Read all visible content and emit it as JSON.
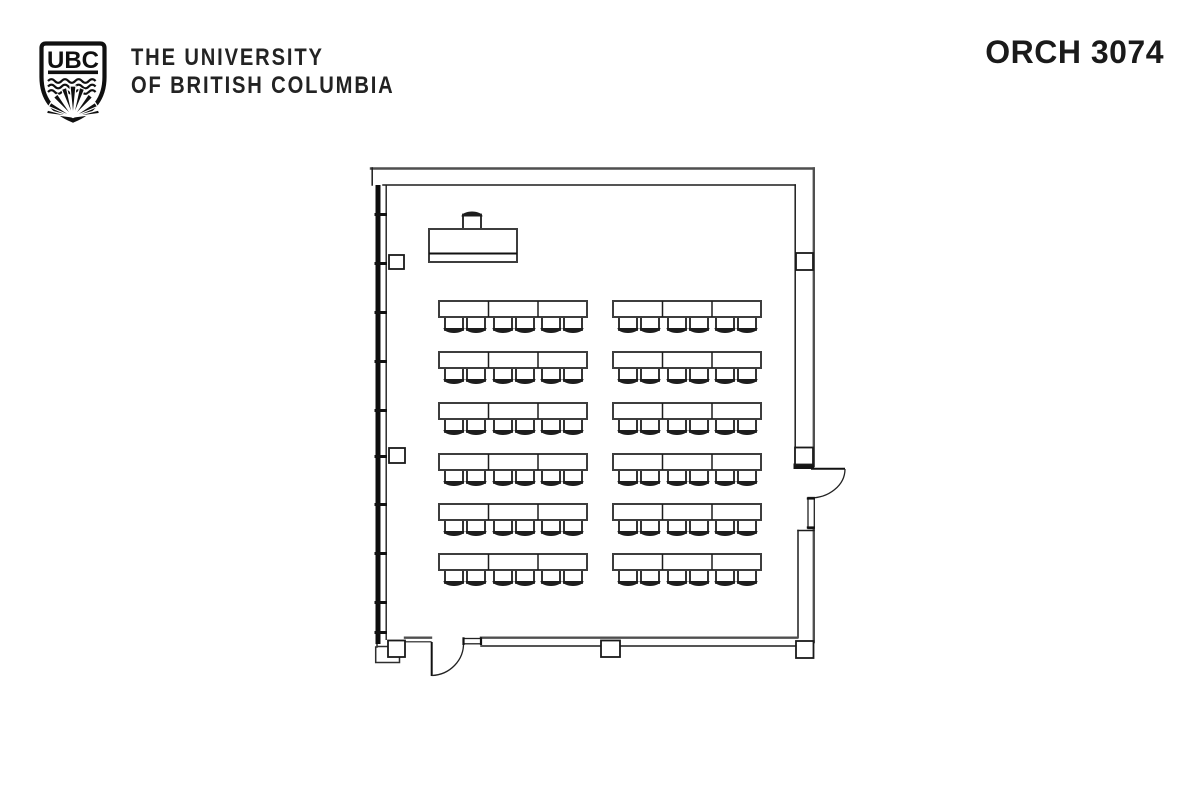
{
  "header": {
    "crest_text": "UBC",
    "wordmark_line1": "THE UNIVERSITY",
    "wordmark_line2": "OF BRITISH COLUMBIA",
    "room_label": "ORCH 3074"
  },
  "colors": {
    "ink": "#1d1d1d",
    "wall_gray": "#4f4f4f",
    "furniture_stroke": "#3d3d3d",
    "fill": "#ffffff"
  },
  "floor_plan": {
    "seating": {
      "row_y": [
        301,
        352,
        403,
        454,
        504,
        554
      ],
      "block_x": [
        439,
        613
      ],
      "block_width": 148,
      "table_height": 16,
      "section_dividers": [
        49.5,
        99
      ],
      "chair_offsets": [
        6,
        28,
        55,
        77,
        103,
        125
      ],
      "chair_width": 18,
      "chair_height": 13
    },
    "instructor": {
      "table": {
        "x": 429,
        "y": 229,
        "width": 88,
        "height": 33
      },
      "front_edge_y": 253.5,
      "chair": {
        "x": 463,
        "y": 214.5,
        "width": 18,
        "height": 15.5
      }
    },
    "columns": [
      {
        "x": 389,
        "y": 255,
        "w": 15,
        "h": 14
      },
      {
        "x": 389,
        "y": 448,
        "w": 16,
        "h": 15
      },
      {
        "x": 796,
        "y": 253,
        "w": 17,
        "h": 17
      },
      {
        "x": 795,
        "y": 447.5,
        "w": 18,
        "h": 17
      },
      {
        "x": 601,
        "y": 640.5,
        "w": 19,
        "h": 16.5
      },
      {
        "x": 796,
        "y": 641,
        "w": 17.5,
        "h": 17
      },
      {
        "x": 388,
        "y": 640.5,
        "w": 17,
        "h": 16.5
      }
    ],
    "window_ticks_y": [
      213,
      262,
      311,
      360,
      409,
      455,
      503,
      552,
      601,
      631
    ]
  }
}
